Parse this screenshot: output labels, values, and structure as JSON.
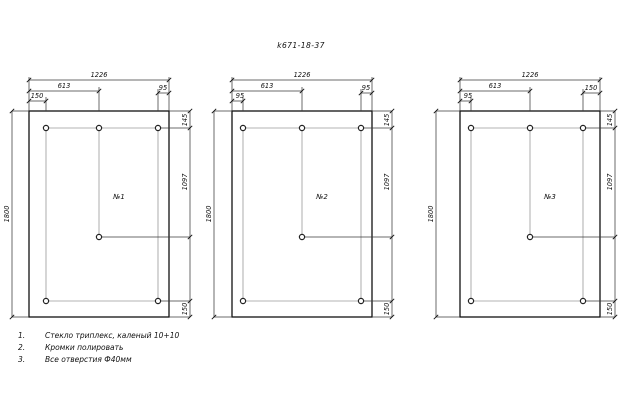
{
  "title": "k671-18-37",
  "drawing": {
    "panels": [
      {
        "label": "№1",
        "width": "1226",
        "height": "1800",
        "mid": "613",
        "left_offset": "150",
        "right_offset": "95",
        "top_offset": "145",
        "mid_drop": "1097",
        "bottom_offset": "150"
      },
      {
        "label": "№2",
        "width": "1226",
        "height": "1800",
        "mid": "613",
        "left_offset": "95",
        "right_offset": "95",
        "top_offset": "145",
        "mid_drop": "1097",
        "bottom_offset": "150"
      },
      {
        "label": "№3",
        "width": "1226",
        "height": "1800",
        "mid": "613",
        "left_offset": "95",
        "right_offset": "150",
        "top_offset": "145",
        "mid_drop": "1097",
        "bottom_offset": "150"
      }
    ],
    "notes": [
      {
        "num": "1.",
        "text": "Стекло триплекс, каленый 10+10"
      },
      {
        "num": "2.",
        "text": "Кромки полировать"
      },
      {
        "num": "3.",
        "text": "Все отверстия Ф40мм"
      }
    ],
    "colors": {
      "line": "#111111",
      "dim": "#3a3a3a",
      "construction": "#b3b3b3",
      "background": "#ffffff"
    }
  }
}
